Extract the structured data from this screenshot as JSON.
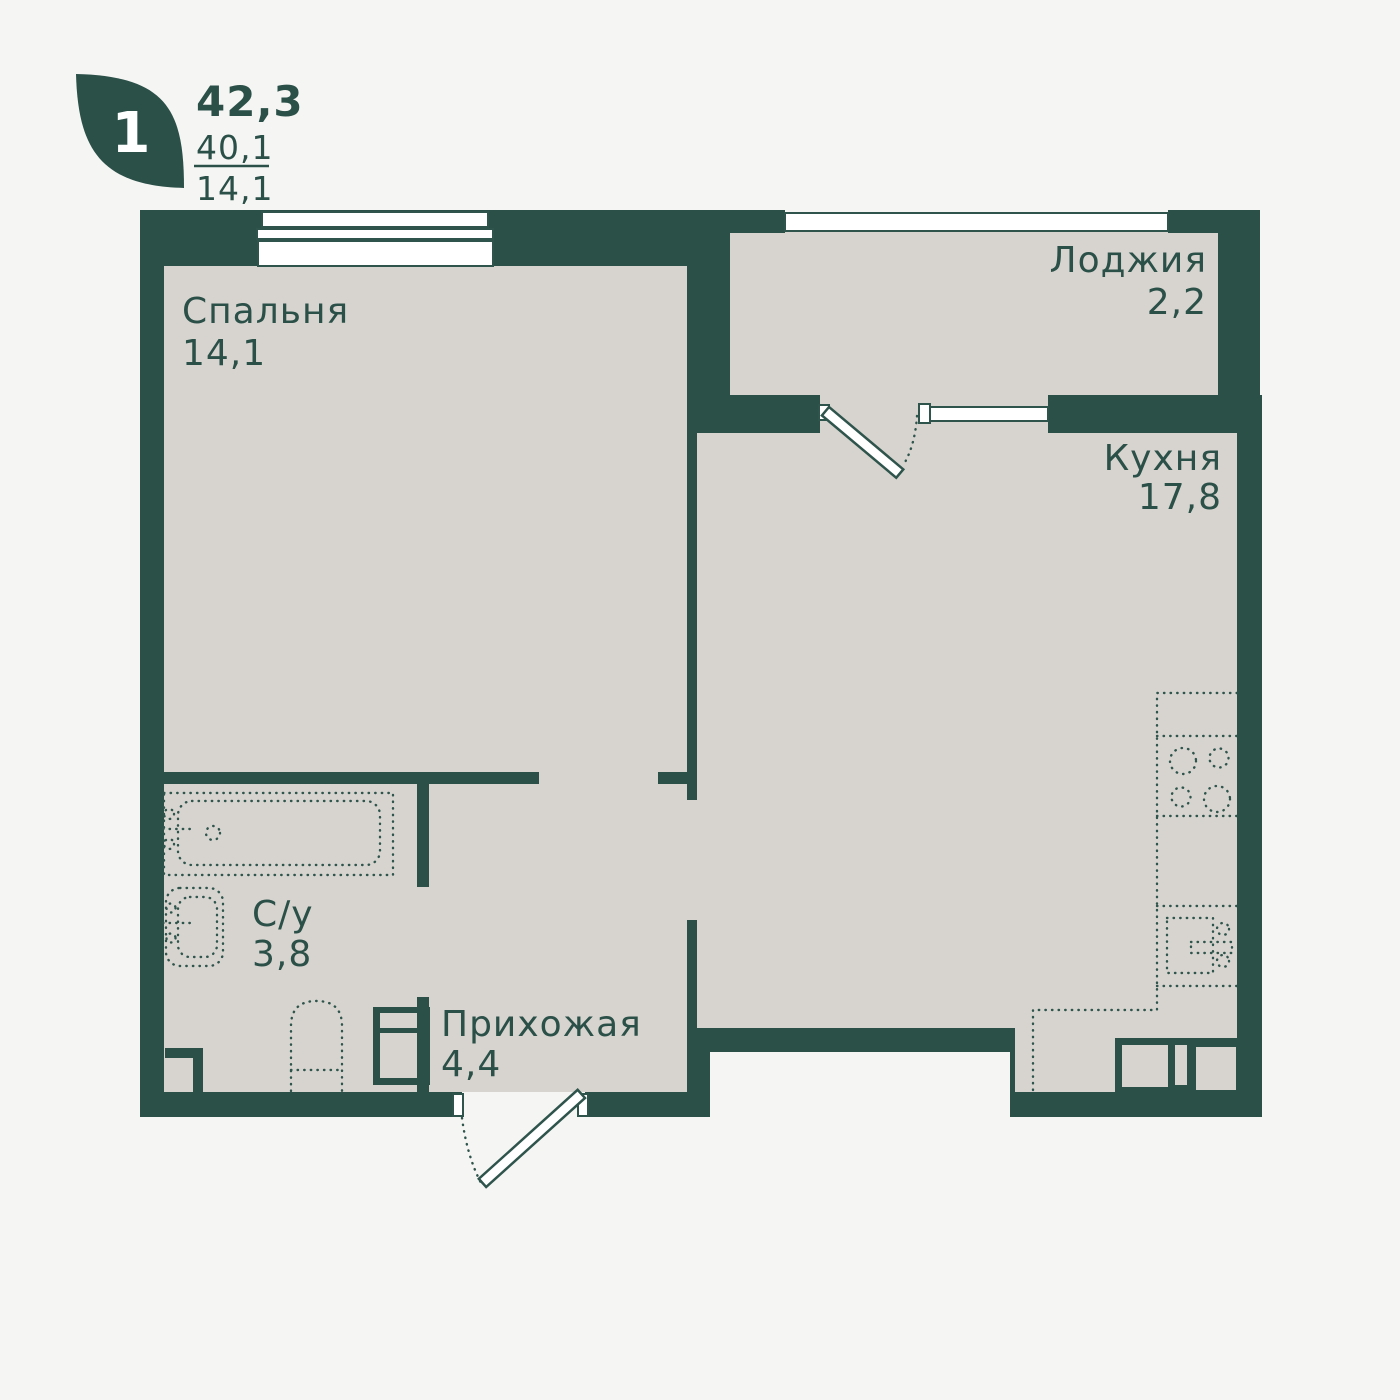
{
  "logo": {
    "icon": "leaf-icon",
    "rooms_count": "1"
  },
  "header": {
    "total_area": "42,3",
    "living_area": "40,1",
    "secondary_area": "14,1"
  },
  "rooms": {
    "bedroom": {
      "name": "Спальня",
      "area": "14,1"
    },
    "loggia": {
      "name": "Лоджия",
      "area": "2,2"
    },
    "kitchen": {
      "name": "Кухня",
      "area": "17,8"
    },
    "bathroom": {
      "name": "С/у",
      "area": "3,8"
    },
    "hallway": {
      "name": "Прихожая",
      "area": "4,4"
    }
  },
  "colors": {
    "wall": "#2b5048",
    "floor": "#d7d4d0",
    "background": "#f5f5f3",
    "window": "#ffffff",
    "line": "#2e544b"
  }
}
